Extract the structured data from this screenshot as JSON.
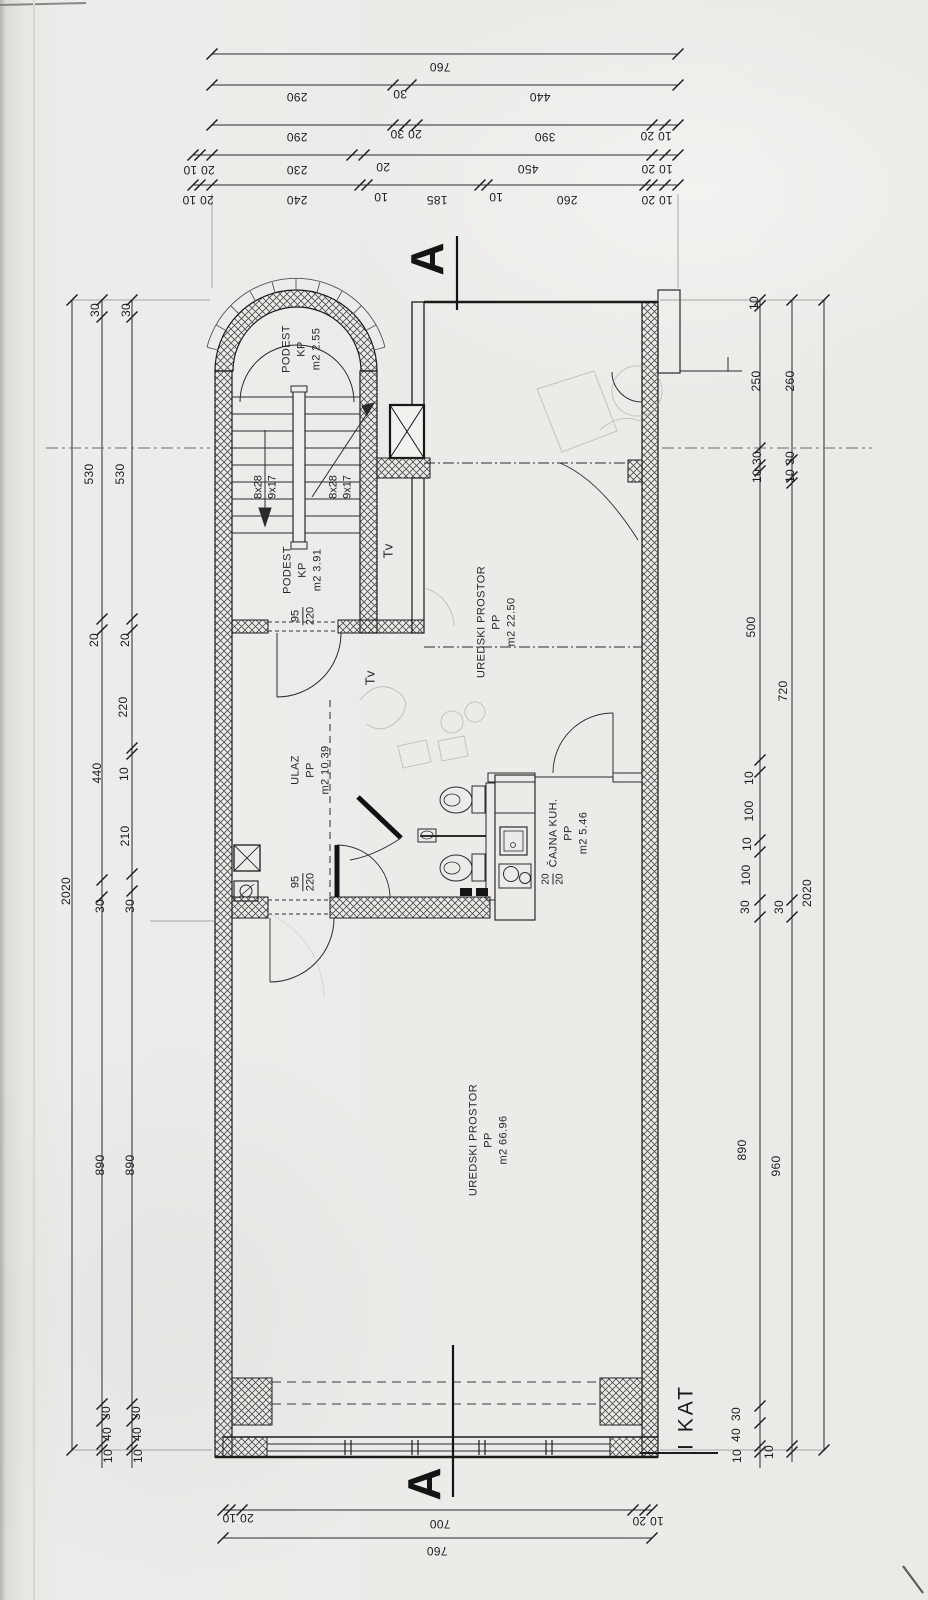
{
  "sheet": {
    "floor_label": "I KAT",
    "section_letter_top": "A",
    "section_letter_bottom": "A"
  },
  "rooms": {
    "podest_top": {
      "lines": [
        "PODEST",
        "KP",
        "m2 2.55"
      ]
    },
    "podest_bottom": {
      "lines": [
        "PODEST",
        "KP",
        "m2 3.91"
      ]
    },
    "office_upper": {
      "lines": [
        "UREDSKI PROSTOR",
        "PP",
        "m2 22.50"
      ]
    },
    "entry": {
      "lines": [
        "ULAZ",
        "PP",
        "m2 10.39"
      ]
    },
    "tea_kitchen": {
      "lines": [
        "ČAJNA KUH.",
        "PP",
        "m2 5.46"
      ],
      "extra_fraction": {
        "num": "20",
        "den": "20"
      }
    },
    "office_lower": {
      "lines": [
        "UREDSKI PROSTOR",
        "PP",
        "m2 66.96"
      ]
    }
  },
  "stairs": {
    "left_flight": [
      "8x28",
      "9x17"
    ],
    "right_flight": [
      "8x28",
      "9x17"
    ],
    "tv_upper": "Tv",
    "tv_lower": "Tv"
  },
  "doors": {
    "stair_door": {
      "num": "95",
      "den": "220"
    },
    "hall_door": {
      "num": "95",
      "den": "220"
    }
  },
  "dims": {
    "top": {
      "r1": [
        "760"
      ],
      "r2": [
        "290",
        "30",
        "440"
      ],
      "r3": [
        "290",
        "20 30",
        "390",
        "10 20"
      ],
      "r4": [
        "20 10",
        "230",
        "20",
        "450",
        "10 20"
      ],
      "r5": [
        "20 10",
        "240",
        "10",
        "185",
        "10",
        "260",
        "10 20"
      ]
    },
    "bottom": {
      "r1": [
        "20 10",
        "700",
        "10 20"
      ],
      "r2": [
        "760"
      ]
    },
    "left": {
      "outer": [
        "2020"
      ],
      "middle": [
        "30",
        "530",
        "20",
        "440",
        "30",
        "890",
        "30",
        "40",
        "10"
      ],
      "inner": [
        "30",
        "530",
        "20",
        "220",
        "10",
        "210",
        "30",
        "890",
        "30",
        "40",
        "10"
      ]
    },
    "right": {
      "inner": [
        "10",
        "250",
        "30",
        "10",
        "500",
        "10",
        "100",
        "10",
        "100",
        "30",
        "890",
        "30",
        "40",
        "10"
      ],
      "middle": [
        "260",
        "30",
        "10",
        "720",
        "30",
        "960",
        "10"
      ],
      "outer": [
        "2020"
      ]
    }
  }
}
